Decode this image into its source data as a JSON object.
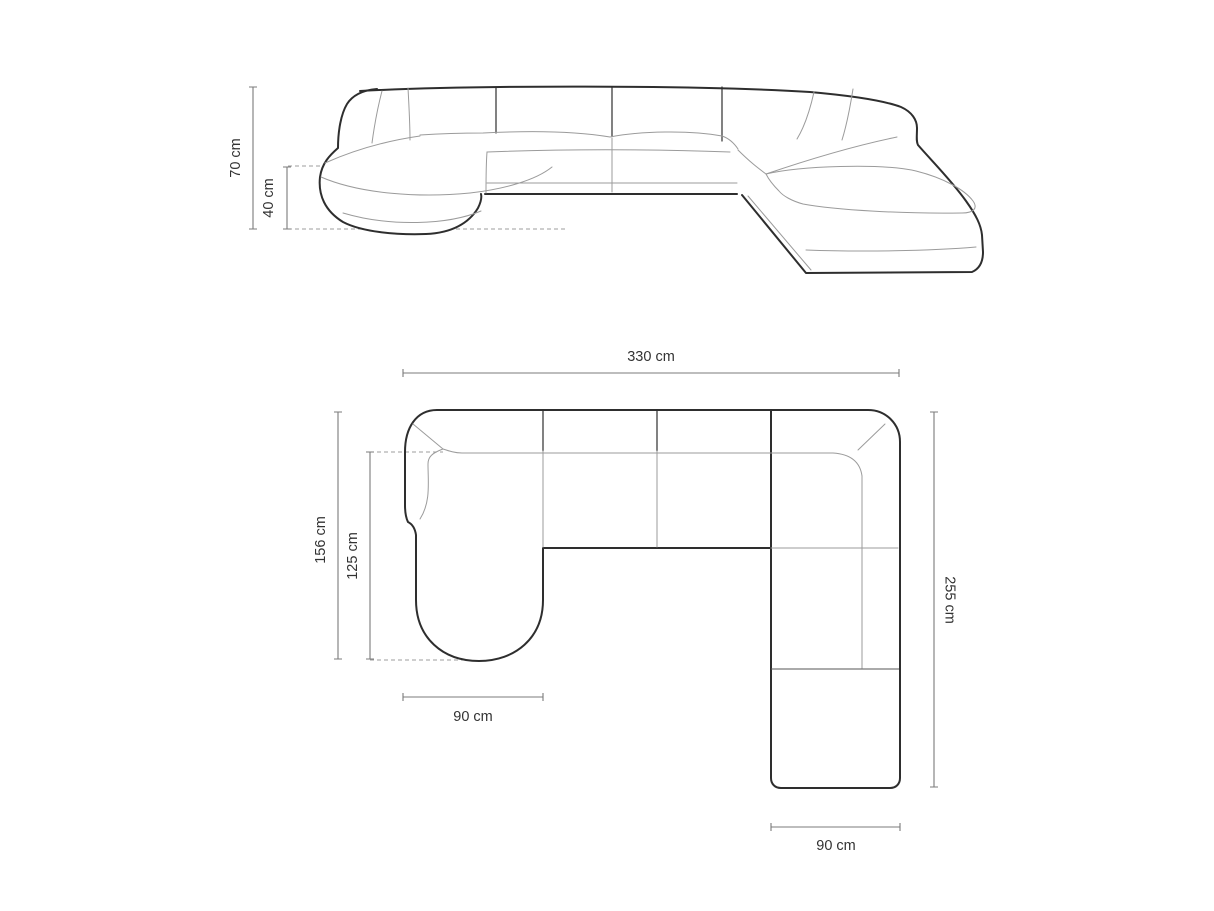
{
  "page": {
    "title": "Panoramic corner sofa — dimensions drawing",
    "background": "#ffffff"
  },
  "colors": {
    "outline": "#2e2e2e",
    "seam": "#9b9b9b",
    "dimension": "#7b7b7b",
    "dashed": "#9e9e9e",
    "text": "#333333",
    "background": "#ffffff"
  },
  "views": {
    "front": {
      "name": "front-elevation-view",
      "dimensions": [
        {
          "id": "total-height",
          "label": "70 cm",
          "value": 70,
          "unit": "cm"
        },
        {
          "id": "seat-height",
          "label": "40 cm",
          "value": 40,
          "unit": "cm"
        }
      ]
    },
    "plan": {
      "name": "top-plan-view",
      "dimensions": [
        {
          "id": "total-width",
          "label": "330 cm",
          "value": 330,
          "unit": "cm"
        },
        {
          "id": "chaise-total-depth",
          "label": "156 cm",
          "value": 156,
          "unit": "cm"
        },
        {
          "id": "chaise-inner-depth",
          "label": "125 cm",
          "value": 125,
          "unit": "cm"
        },
        {
          "id": "total-depth",
          "label": "255 cm",
          "value": 255,
          "unit": "cm"
        },
        {
          "id": "chaise-width",
          "label": "90 cm",
          "value": 90,
          "unit": "cm"
        },
        {
          "id": "ottoman-width",
          "label": "90 cm",
          "value": 90,
          "unit": "cm"
        }
      ]
    }
  }
}
